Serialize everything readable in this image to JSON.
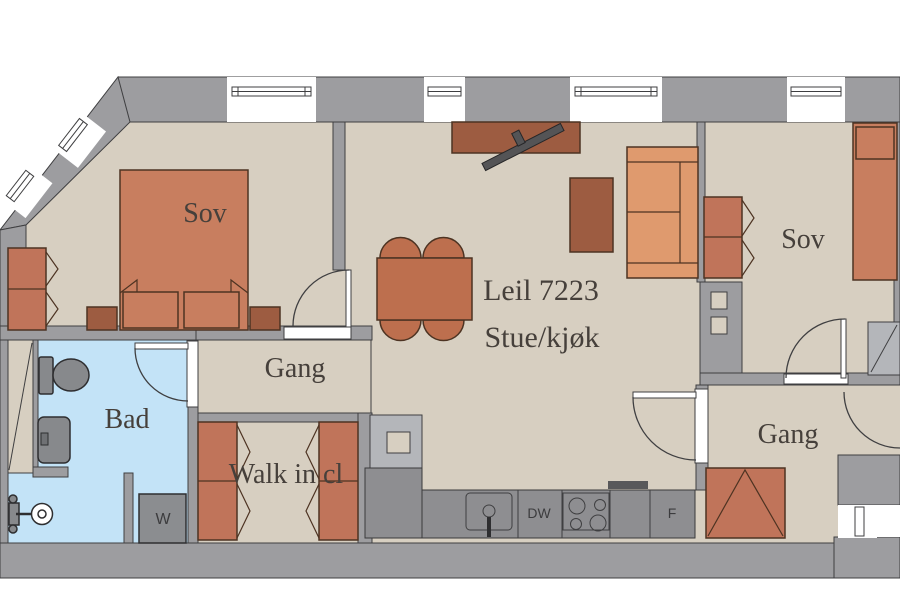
{
  "plan": {
    "apartment_label": "Leil 7223",
    "rooms": {
      "bedroom_left": {
        "label": "Sov"
      },
      "bedroom_right": {
        "label": "Sov"
      },
      "bathroom": {
        "label": "Bad"
      },
      "hall_upper": {
        "label": "Gang"
      },
      "hall_entry": {
        "label": "Gang"
      },
      "walk_in_closet": {
        "label": "Walk in cl"
      },
      "living_kitchen": {
        "label": "Stue/kjøk"
      }
    },
    "appliances": {
      "washer": "W",
      "dishwasher": "DW",
      "fridge": "F"
    },
    "colors": {
      "wall": "#9d9da0",
      "wall_light": "#b4b6ba",
      "floor": "#d7cfc1",
      "bathroom_floor": "#c3e3f7",
      "furniture": "#c87e5f",
      "furniture_dark": "#9d5c41",
      "sofa": "#df9a6e",
      "wardrobe": "#c0745a",
      "counter": "#8e8e91",
      "fixture": "#87898c",
      "outline": "#3f3f41",
      "label_text": "#46403b"
    }
  }
}
